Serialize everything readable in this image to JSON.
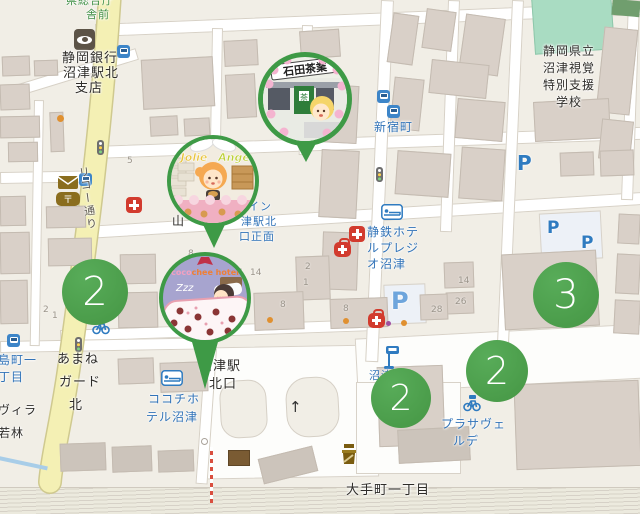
{
  "map": {
    "type": "street-map (OSM style), Numazu Station north area, Japan",
    "colors": {
      "pin_green": "#3e9a46",
      "cluster_green": "#4a9e4e",
      "label_blue": "#3173b8",
      "label_black": "#2e2c29",
      "bus_stop_green": "#3f8f45",
      "road_yellow": "#f4f0b4",
      "background": "#f1eee6"
    },
    "labels": {
      "bus_stop_top": {
        "line1": "県総合庁",
        "line2": "舎前"
      },
      "bank": {
        "line1": "静岡銀行",
        "line2": "沼津駅北",
        "line3": "支店"
      },
      "school": {
        "line1": "静岡県立",
        "line2": "沼津視覚",
        "line3": "特別支援",
        "line4": "学校"
      },
      "shinjukucho": "新宿町",
      "hotel_presio": {
        "line1": "静鉄ホテ",
        "line2": "ルプレジ",
        "line3": "オ沼津"
      },
      "hotel_select_inn": {
        "line1": "イン",
        "line2": "津駅北",
        "line3": "口正面"
      },
      "yama": "山",
      "station_north": {
        "line1": "沼津駅",
        "line2": "北口"
      },
      "shimacho": {
        "line1": "島町一",
        "line2": "丁目"
      },
      "amane_guard": {
        "line1": "あまね",
        "line2": "ガード",
        "line3": "北"
      },
      "villa": {
        "line1": "ヴィラ",
        "line2": "若林"
      },
      "cocochi_hotel": {
        "line1": "ココチホ",
        "line2": "テル沼津"
      },
      "plaza_verde": {
        "line1": "プラサヴェ",
        "line2": "ルデ"
      },
      "otemachi": "大手町一丁目",
      "numazu_station": "沼津駅",
      "ricoh_street": "リコー通り",
      "parking_letter": "P"
    },
    "clusters": [
      {
        "count": "2",
        "position": "west on Ricoh street"
      },
      {
        "count": "3",
        "position": "east block"
      },
      {
        "count": "2",
        "position": "station plaza center"
      },
      {
        "count": "2",
        "position": "station plaza east"
      }
    ],
    "pins": [
      {
        "name": "ishida-tea-shop",
        "title": "石田茶業"
      },
      {
        "name": "jolie-ange-bakery",
        "title_word1": "Jolie",
        "title_word2": "Ange"
      },
      {
        "name": "cocochee-hotel",
        "title_coco": "coco",
        "title_chee": "chee hotel",
        "sleep_text": "Zzz"
      }
    ],
    "house_numbers": [
      {
        "t": "5"
      },
      {
        "t": "8"
      },
      {
        "t": "1"
      },
      {
        "t": "14"
      },
      {
        "t": "2"
      },
      {
        "t": "1"
      },
      {
        "t": "8"
      },
      {
        "t": "8"
      },
      {
        "t": "14"
      },
      {
        "t": "26"
      },
      {
        "t": "28"
      },
      {
        "t": "2"
      },
      {
        "t": "1"
      }
    ],
    "icons": [
      "bank-icon",
      "post-office-icon",
      "transit-icon",
      "bus-stop-icon",
      "bicycle-parking-icon",
      "traffic-signal-icon",
      "clinic-icon",
      "pharmacy-icon",
      "hotel-bed-icon",
      "shrine-monument-icon",
      "parking-icon",
      "one-way-arrow-icon"
    ]
  }
}
